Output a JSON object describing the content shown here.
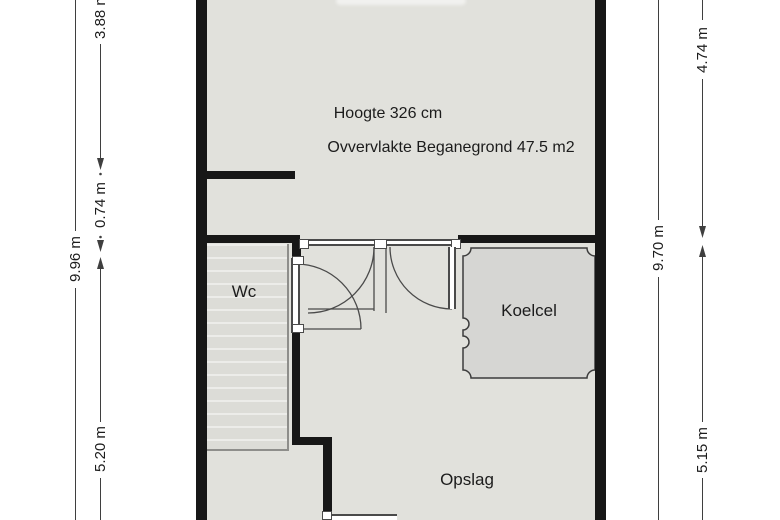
{
  "plan": {
    "main_room": {
      "height_note": "Hoogte 326 cm",
      "area_note": "Ovvervlakte Beganegrond 47.5 m2"
    },
    "rooms": {
      "wc": "Wc",
      "koelcel": "Koelcel",
      "opslag": "Opslag"
    },
    "dimensions_left": {
      "total": "9.96 m",
      "top": "3.88 m",
      "middle": "0.74 m",
      "bottom": "5.20 m"
    },
    "dimensions_right": {
      "total": "9.70 m",
      "top": "4.74 m",
      "bottom": "5.15 m"
    },
    "colors": {
      "floor": "#e1e1dc",
      "wc_floor": "#dcdcd7",
      "koelcel_fill": "#d6d6d3",
      "wall": "#171717",
      "dim_line": "#3f3f3f",
      "outline": "#4a4a4a",
      "text": "#1c1c1c"
    }
  }
}
